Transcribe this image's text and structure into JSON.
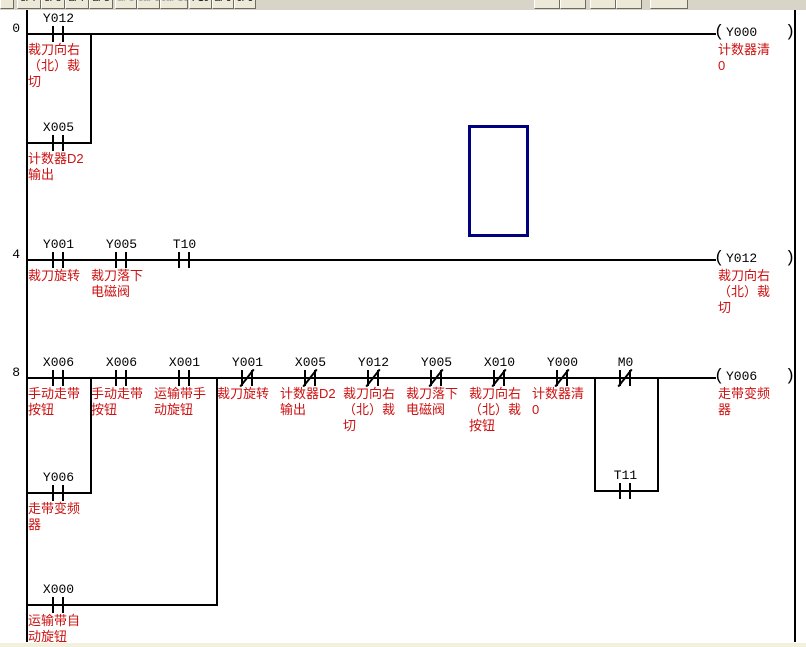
{
  "window": {
    "kind": "plc-ladder-editor"
  },
  "colors": {
    "comment": "#cc1111",
    "line": "#000000",
    "cursor": "#000080",
    "toolbar_bg": "#d8d4c8",
    "button_bg": "#ece9d8",
    "bottom_strip": "#f4f0de"
  },
  "toolbar": {
    "buttons": [
      {
        "x": 0,
        "w": 14,
        "label": "",
        "dim": false
      },
      {
        "x": 17,
        "w": 24,
        "label": "sF7",
        "dim": false
      },
      {
        "x": 41,
        "w": 24,
        "label": "sF8",
        "dim": false
      },
      {
        "x": 65,
        "w": 24,
        "label": "aF7",
        "dim": false
      },
      {
        "x": 89,
        "w": 24,
        "label": "aF8",
        "dim": false
      },
      {
        "x": 115,
        "w": 22,
        "label": "aF5",
        "dim": true
      },
      {
        "x": 137,
        "w": 23,
        "label": "caF5",
        "dim": true
      },
      {
        "x": 160,
        "w": 28,
        "label": "caF10",
        "dim": true
      },
      {
        "x": 189,
        "w": 23,
        "label": "F10",
        "dim": false
      },
      {
        "x": 212,
        "w": 22,
        "label": "aF9",
        "dim": false
      },
      {
        "x": 234,
        "w": 22,
        "label": "cF9",
        "dim": false
      },
      {
        "x": 534,
        "w": 26,
        "label": "",
        "dim": false
      },
      {
        "x": 560,
        "w": 26,
        "label": "",
        "dim": false
      },
      {
        "x": 590,
        "w": 26,
        "label": "",
        "dim": false
      },
      {
        "x": 616,
        "w": 26,
        "label": "",
        "dim": false
      },
      {
        "x": 650,
        "w": 38,
        "label": "",
        "dim": false
      }
    ]
  },
  "ladder": {
    "rail_left": 26,
    "rail_right": 794,
    "cell_w": 63,
    "canvas_top": 10,
    "canvas_bottom": 647,
    "coil_x": 714,
    "rungs": [
      {
        "step": "0",
        "y": 33,
        "contacts": [
          {
            "cell": 0,
            "device": "Y012",
            "type": "no",
            "comment": [
              "裁刀向右",
              "（北）裁",
              "切"
            ]
          }
        ],
        "coil": {
          "device": "Y000",
          "comment": [
            "计数器清",
            "0"
          ]
        },
        "branches": [
          {
            "y": 142,
            "x1": 26,
            "x2": 90,
            "contacts": [
              {
                "cell": 0,
                "device": "X005",
                "type": "no",
                "comment": [
                  "计数器D2",
                  "输出"
                ]
              }
            ]
          }
        ]
      },
      {
        "step": "4",
        "y": 259,
        "contacts": [
          {
            "cell": 0,
            "device": "Y001",
            "type": "no",
            "comment": [
              "裁刀旋转"
            ]
          },
          {
            "cell": 1,
            "device": "Y005",
            "type": "no",
            "comment": [
              "裁刀落下",
              "电磁阀"
            ]
          },
          {
            "cell": 2,
            "device": "T10",
            "type": "no",
            "comment": []
          }
        ],
        "coil": {
          "device": "Y012",
          "comment": [
            "裁刀向右",
            "（北）裁",
            "切"
          ]
        },
        "branches": []
      },
      {
        "step": "8",
        "y": 377,
        "contacts": [
          {
            "cell": 0,
            "device": "X006",
            "type": "no",
            "comment": [
              "手动走带",
              "按钮"
            ]
          },
          {
            "cell": 1,
            "device": "X006",
            "type": "no",
            "comment": [
              "手动走带",
              "按钮"
            ]
          },
          {
            "cell": 2,
            "device": "X001",
            "type": "no",
            "comment": [
              "运输带手",
              "动旋钮"
            ]
          },
          {
            "cell": 3,
            "device": "Y001",
            "type": "nc",
            "comment": [
              "裁刀旋转"
            ]
          },
          {
            "cell": 4,
            "device": "X005",
            "type": "nc",
            "comment": [
              "计数器D2",
              "输出"
            ]
          },
          {
            "cell": 5,
            "device": "Y012",
            "type": "nc",
            "comment": [
              "裁刀向右",
              "（北）裁",
              "切"
            ]
          },
          {
            "cell": 6,
            "device": "Y005",
            "type": "nc",
            "comment": [
              "裁刀落下",
              "电磁阀"
            ]
          },
          {
            "cell": 7,
            "device": "X010",
            "type": "nc",
            "comment": [
              "裁刀向右",
              "（北）裁",
              "按钮"
            ]
          },
          {
            "cell": 8,
            "device": "Y000",
            "type": "nc",
            "comment": [
              "计数器清",
              "0"
            ]
          },
          {
            "cell": 9,
            "device": "M0",
            "type": "nc",
            "comment": []
          }
        ],
        "coil": {
          "device": "Y006",
          "comment": [
            "走带变频",
            "器"
          ]
        },
        "branches": [
          {
            "y": 492,
            "x1": 26,
            "x2": 90,
            "contacts": [
              {
                "cell": 0,
                "device": "Y006",
                "type": "no",
                "comment": [
                  "走带变频",
                  "器"
                ]
              }
            ]
          },
          {
            "y": 604,
            "x1": 26,
            "x2": 216,
            "contacts": [
              {
                "cell": 0,
                "device": "X000",
                "type": "no",
                "comment": [
                  "运输带自",
                  "动旋钮"
                ]
              }
            ]
          },
          {
            "y": 490,
            "x1": 594,
            "x2": 657,
            "contacts": [
              {
                "cell": 9,
                "device": "T11",
                "type": "no",
                "comment": []
              }
            ]
          }
        ]
      }
    ]
  },
  "cursor": {
    "x": 468,
    "y": 125,
    "w": 61,
    "h": 112
  }
}
